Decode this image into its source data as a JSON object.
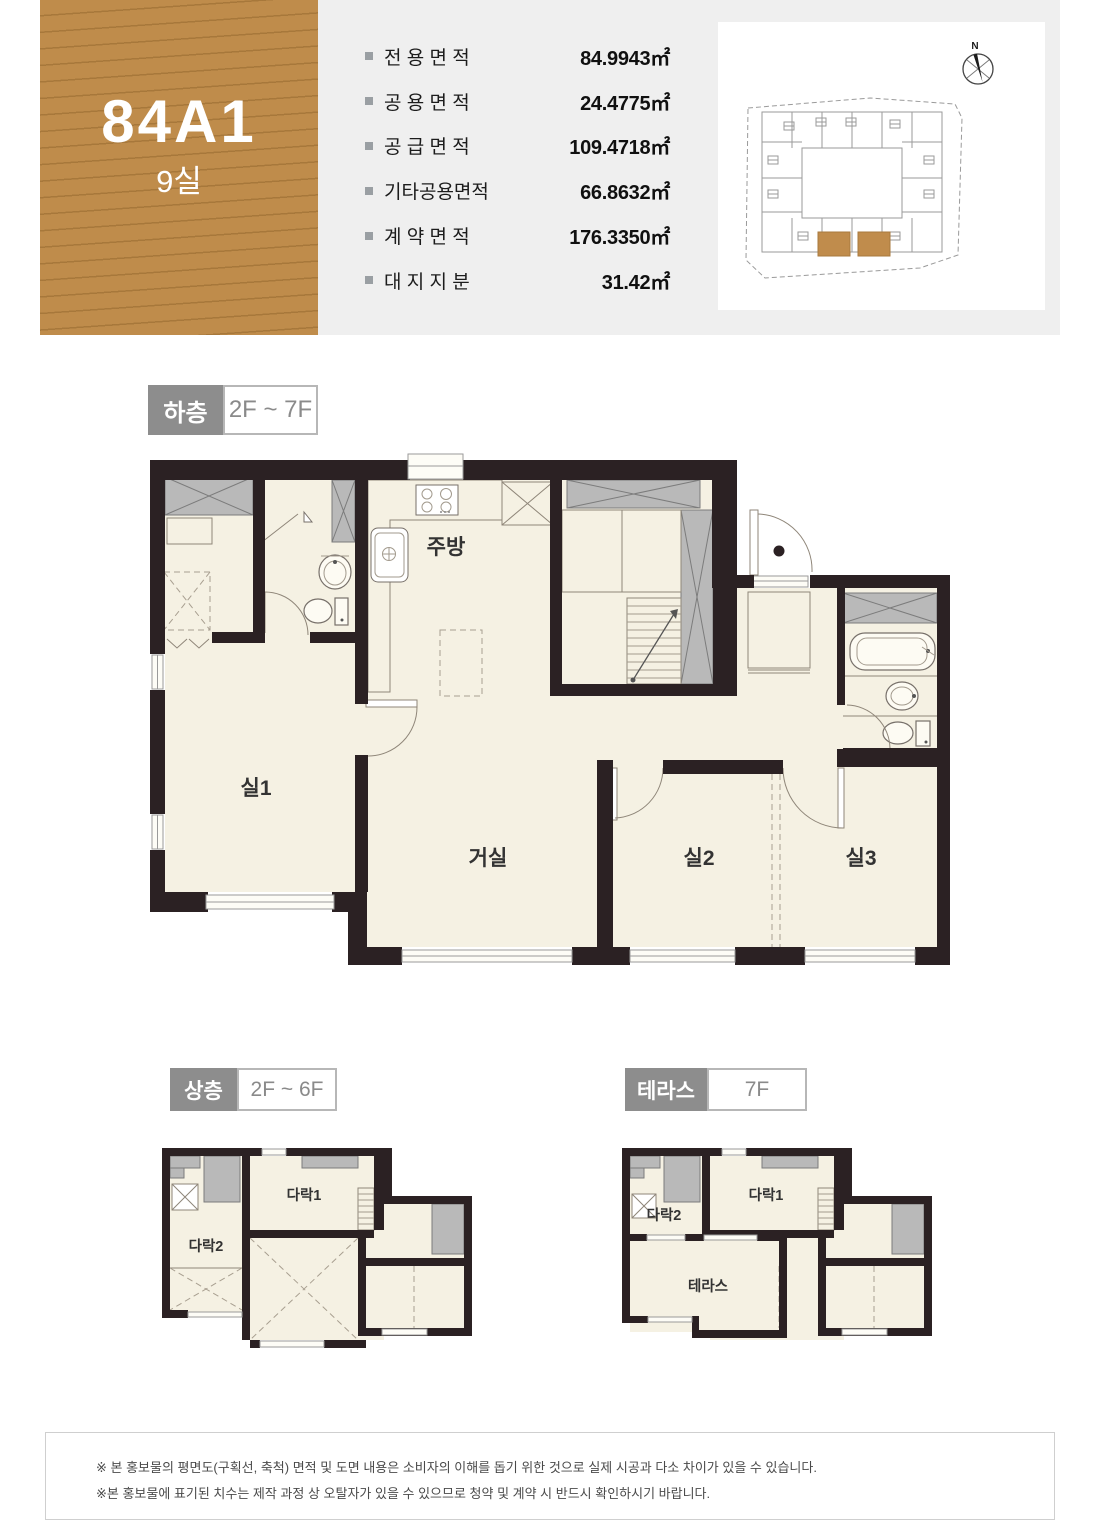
{
  "header": {
    "unit_code": "84A1",
    "unit_count": "9실",
    "specs": [
      {
        "label": "전 용 면 적",
        "value": "84.9943㎡"
      },
      {
        "label": "공 용 면 적",
        "value": "24.4775㎡"
      },
      {
        "label": "공 급 면 적",
        "value": "109.4718㎡"
      },
      {
        "label": "기타공용면적",
        "value": "66.8632㎡"
      },
      {
        "label": "계 약 면 적",
        "value": "176.3350㎡"
      },
      {
        "label": "대 지 지 분",
        "value": "31.42㎡"
      }
    ]
  },
  "siteplan": {
    "compass_north": "N"
  },
  "plans": {
    "lower": {
      "tag": "하층",
      "range": "2F ~ 7F",
      "rooms": {
        "kitchen": "주방",
        "room1": "실1",
        "living": "거실",
        "room2": "실2",
        "room3": "실3"
      }
    },
    "upper": {
      "tag": "상층",
      "range": "2F ~ 6F",
      "rooms": {
        "attic1": "다락1",
        "attic2": "다락2"
      }
    },
    "terrace": {
      "tag": "테라스",
      "range": "7F",
      "rooms": {
        "attic1": "다락1",
        "attic2": "다락2",
        "terrace": "테라스"
      }
    }
  },
  "disclaimer": {
    "line1": "※ 본 홍보물의 평면도(구획선, 축척) 면적 및 도면 내용은 소비자의 이해를 돕기 위한 것으로 실제 시공과 다소 차이가 있을 수 있습니다.",
    "line2": "※본 홍보물에 표기된 치수는 제작 과정 상 오탈자가 있을 수 있으므로 청약 및 계약 시 반드시 확인하시기 바랍니다."
  },
  "colors": {
    "accent_brown": "#bf8c4b",
    "panel_gray": "#efefef",
    "wall_dark": "#2b2123",
    "floor_cream": "#f5f1e3",
    "tag_gray": "#8d8d8d"
  }
}
